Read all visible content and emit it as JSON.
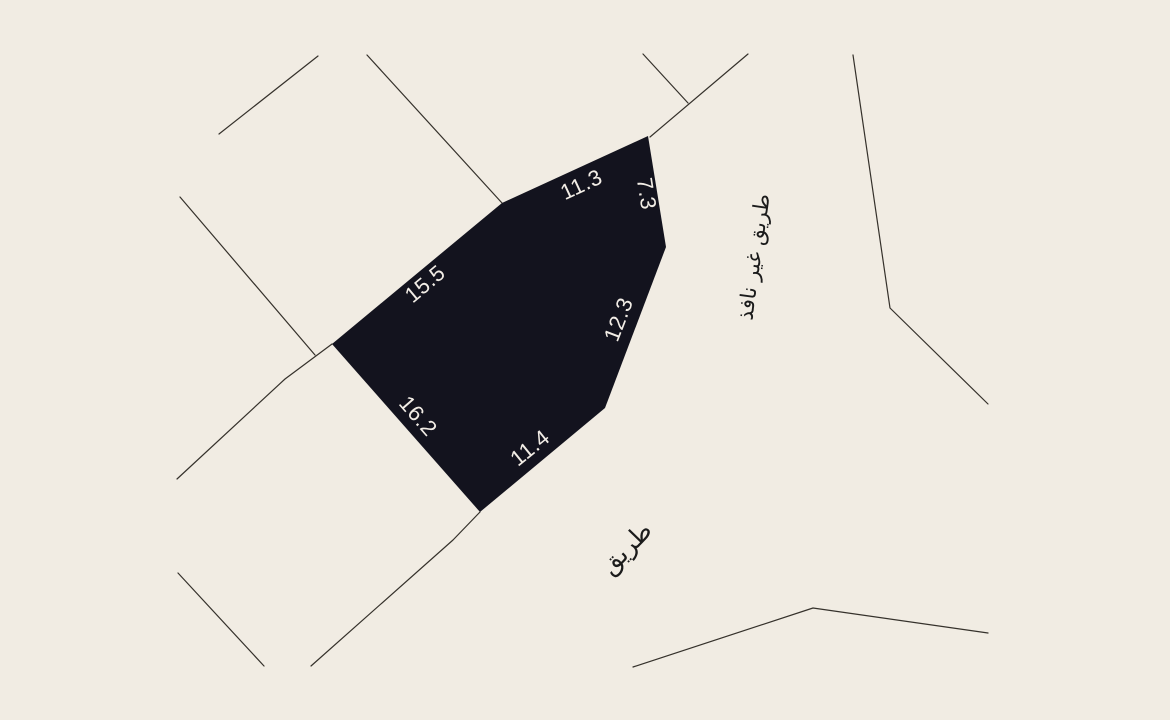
{
  "map": {
    "background_color": "#f1ece3",
    "line_color": "#35312b",
    "road_text_color": "#1b1b1b",
    "parcel": {
      "fill_color": "#13131e",
      "label_color": "#f2ede6",
      "label_font_size": 22,
      "points": "648,136 666,247 605,408 480,512 332,344 502,203",
      "dimension_labels": [
        {
          "text": "11.3",
          "x": 582,
          "y": 186,
          "rotation": -25
        },
        {
          "text": "7.3",
          "x": 645,
          "y": 194,
          "rotation": 81
        },
        {
          "text": "12.3",
          "x": 620,
          "y": 320,
          "rotation": -69
        },
        {
          "text": "15.5",
          "x": 426,
          "y": 285,
          "rotation": -40
        },
        {
          "text": "16.2",
          "x": 417,
          "y": 417,
          "rotation": 49
        },
        {
          "text": "11.4",
          "x": 531,
          "y": 449,
          "rotation": -39
        }
      ]
    },
    "boundary_lines": [
      {
        "name": "boundary-line-1",
        "points": "219,134 318,56"
      },
      {
        "name": "boundary-line-2",
        "points": "367,55 502,203"
      },
      {
        "name": "boundary-line-3",
        "points": "180,197 315,355"
      },
      {
        "name": "boundary-line-4",
        "points": "332,344 285,379 177,479"
      },
      {
        "name": "boundary-line-5",
        "points": "480,512 453,540 311,666"
      },
      {
        "name": "boundary-line-6",
        "points": "178,573 264,666"
      },
      {
        "name": "boundary-line-7",
        "points": "853,55 890,308 988,404"
      },
      {
        "name": "boundary-line-8",
        "points": "633,667 813,608 988,633"
      },
      {
        "name": "boundary-line-9",
        "points": "748,54 650,137"
      },
      {
        "name": "boundary-line-10",
        "points": "643,54 688,103"
      }
    ],
    "road_labels": [
      {
        "text": "طريق غير نافذ",
        "x": 755,
        "y": 257,
        "rotation": -82,
        "font_size": 21
      },
      {
        "text": "طريق",
        "x": 627,
        "y": 549,
        "rotation": -46,
        "font_size": 25
      }
    ]
  }
}
